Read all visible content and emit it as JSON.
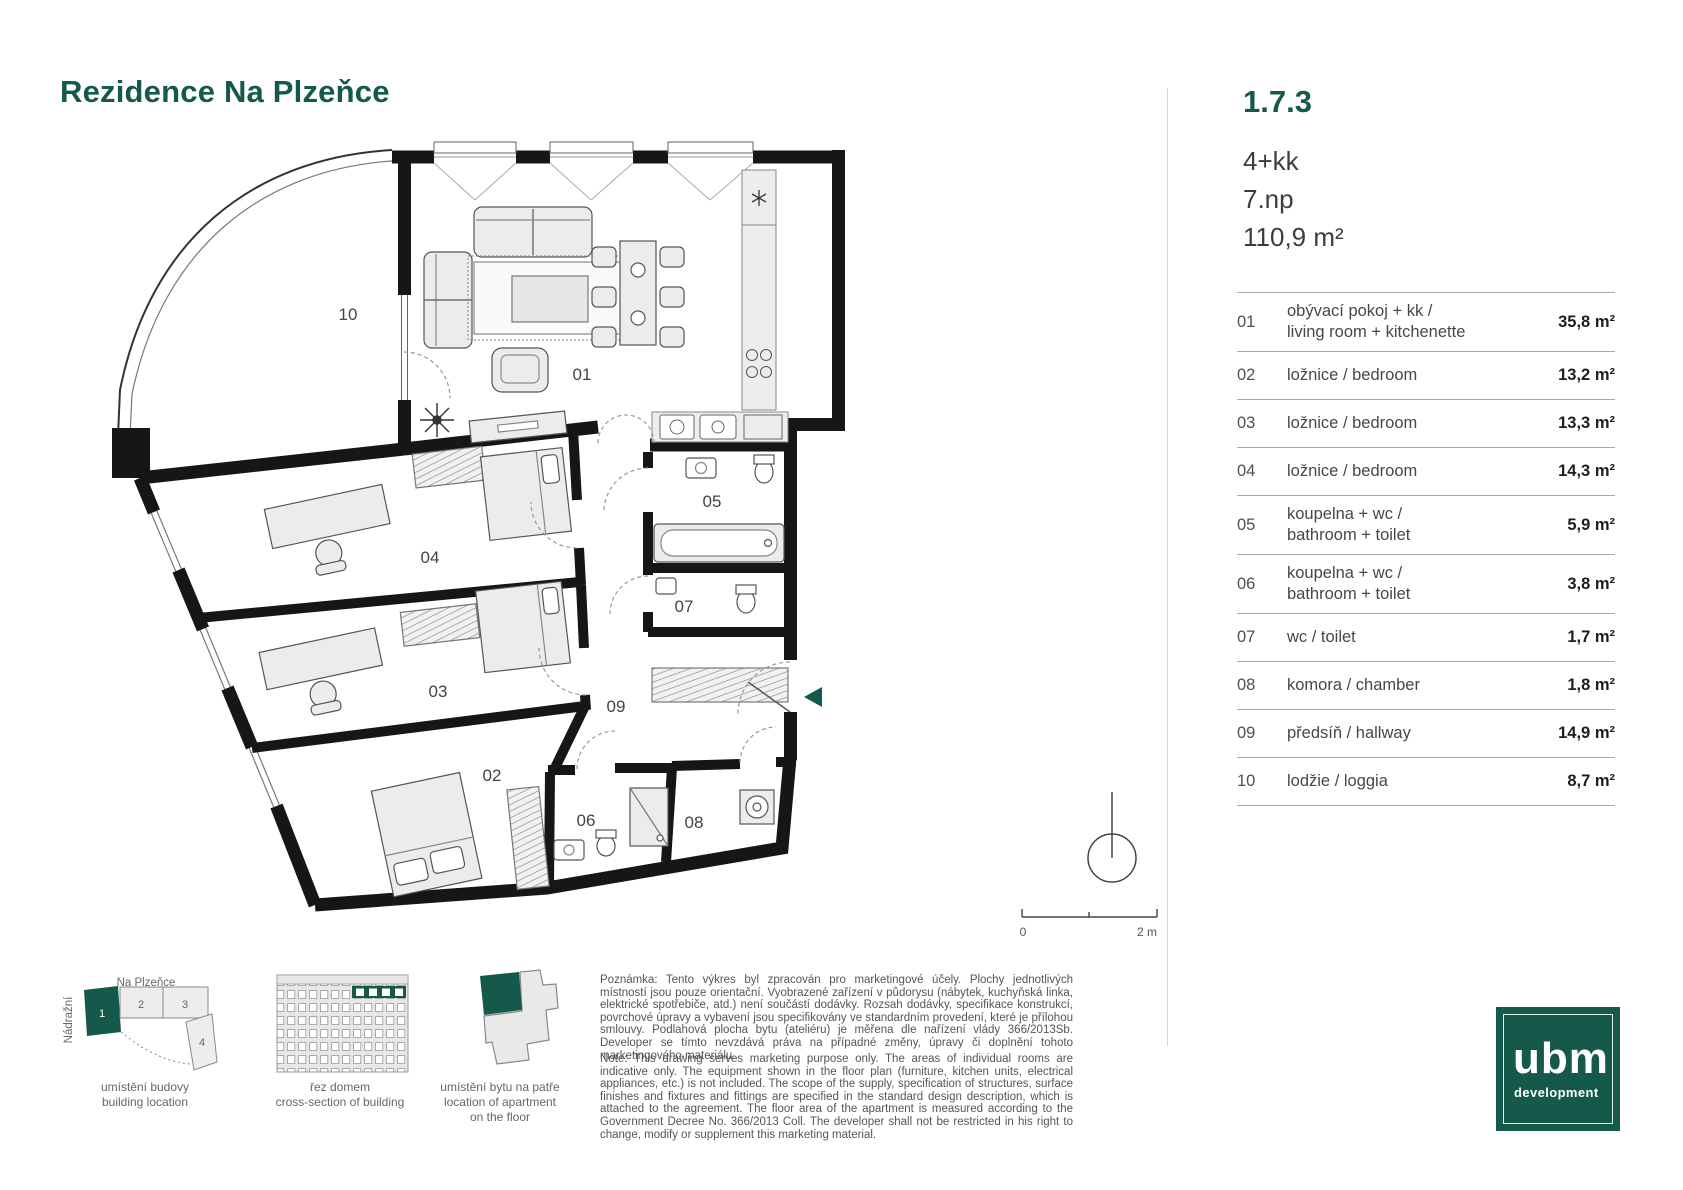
{
  "title": "Rezidence Na Plzeňce",
  "brand_green": "#14594a",
  "unit": {
    "id": "1.7.3",
    "layout": "4+kk",
    "floor": "7.np",
    "area": "110,9 m²"
  },
  "rooms": [
    {
      "num": "01",
      "label1": "obývací pokoj + kk /",
      "label2": "living room + kitchenette",
      "area": "35,8 m²"
    },
    {
      "num": "02",
      "label1": "ložnice / bedroom",
      "label2": "",
      "area": "13,2 m²"
    },
    {
      "num": "03",
      "label1": "ložnice / bedroom",
      "label2": "",
      "area": "13,3 m²"
    },
    {
      "num": "04",
      "label1": "ložnice / bedroom",
      "label2": "",
      "area": "14,3 m²"
    },
    {
      "num": "05",
      "label1": "koupelna + wc /",
      "label2": "bathroom + toilet",
      "area": "5,9 m²"
    },
    {
      "num": "06",
      "label1": "koupelna + wc /",
      "label2": "bathroom + toilet",
      "area": "3,8 m²"
    },
    {
      "num": "07",
      "label1": "wc / toilet",
      "label2": "",
      "area": "1,7 m²"
    },
    {
      "num": "08",
      "label1": "komora / chamber",
      "label2": "",
      "area": "1,8 m²"
    },
    {
      "num": "09",
      "label1": "předsíň / hallway",
      "label2": "",
      "area": "14,9 m²"
    },
    {
      "num": "10",
      "label1": "lodžie / loggia",
      "label2": "",
      "area": "8,7 m²"
    }
  ],
  "scalebar": {
    "zero": "0",
    "max": "2 m"
  },
  "diagrams": {
    "location": {
      "street_top": "Na Plzeňce",
      "street_left": "Nádražní",
      "b1": "1",
      "b2": "2",
      "b3": "3",
      "b4": "4",
      "caption_cs": "umístění budovy",
      "caption_en": "building location"
    },
    "section": {
      "caption_cs": "řez domem",
      "caption_en": "cross-section of building"
    },
    "floor_position": {
      "caption_cs": "umístění bytu na patře",
      "caption_en": "location of apartment",
      "caption_en2": "on the floor"
    }
  },
  "notes": {
    "cs": "Poznámka: Tento výkres byl zpracován pro marketingové účely. Plochy jednotlivých místností jsou pouze orientační. Vyobrazené zařízení v půdorysu (nábytek, kuchyňská linka, elektrické spotřebiče, atd.) není součástí dodávky. Rozsah dodávky, specifikace konstrukcí, povrchové úpravy a vybavení jsou specifikovány ve standardním provedení, které je přílohou smlouvy. Podlahová plocha bytu (ateliéru) je měřena dle nařízení vlády 366/2013Sb. Developer se tímto nevzdává práva na případné změny, úpravy či doplnění tohoto marketingového materiálu.",
    "en": "Note: This drawing serves marketing purpose only. The areas of individual rooms are indicative only. The equipment shown in the floor plan (furniture, kitchen units, electrical appliances, etc.) is not included. The scope of the supply, specification of structures, surface finishes and fixtures and fittings are specified in the standard design description, which is attached to the agreement. The floor area of the apartment is measured according to the Government Decree No. 366/2013 Coll. The developer shall not be restricted in his right to change, modify or supplement this marketing material."
  },
  "logo": {
    "brand": "ubm",
    "sub": "development"
  }
}
